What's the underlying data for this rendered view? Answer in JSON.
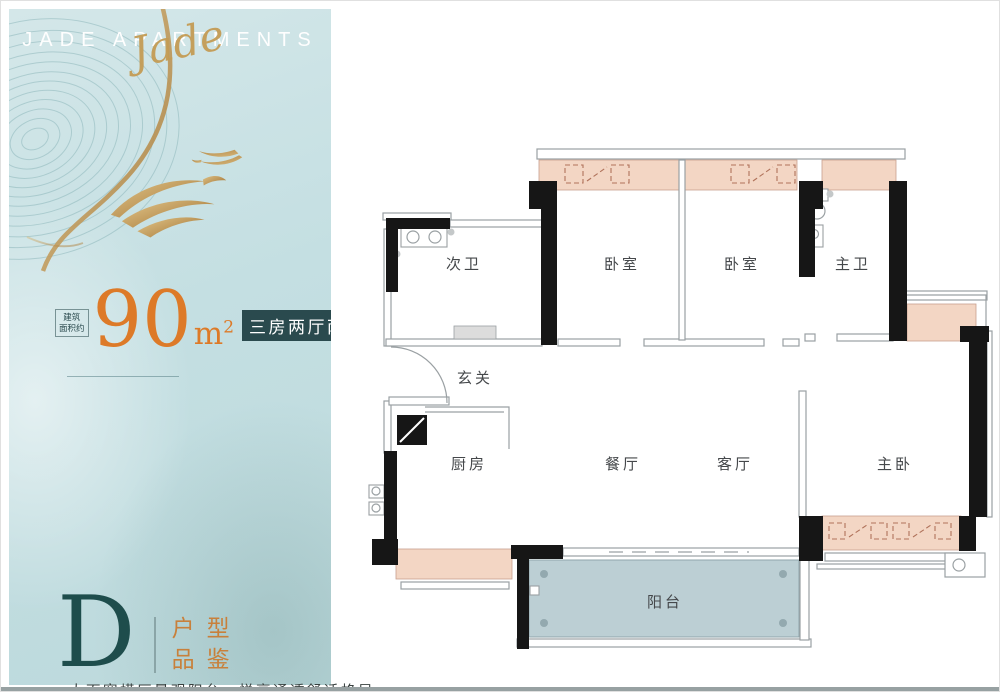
{
  "panel": {
    "brand": "JADE APARTMENTS",
    "brand_script": "Jade",
    "area": {
      "prefix_line1": "建筑",
      "prefix_line2": "面积约",
      "value": "90",
      "unit": "m",
      "unit_sup": "2"
    },
    "badge": "三房两厅两卫",
    "type": {
      "letter": "D",
      "label_line1": "户型",
      "label_line2": "品鉴"
    },
    "footer_caption": "大面宽横厅景观阳台，悦享通透舒适格局"
  },
  "plan": {
    "rooms": [
      {
        "label": "次卫"
      },
      {
        "label": "卧室"
      },
      {
        "label": "卧室"
      },
      {
        "label": "主卫"
      },
      {
        "label": "玄关"
      },
      {
        "label": "厨房"
      },
      {
        "label": "餐厅"
      },
      {
        "label": "客厅"
      },
      {
        "label": "主卧"
      },
      {
        "label": "阳台"
      }
    ]
  },
  "icons": {
    "swallow": "swallow-icon",
    "contours": "contour-lines-art"
  },
  "colors": {
    "accent_orange": "#dd7a28",
    "badge_teal": "#2a4a4e",
    "panel_blue": "#c6dfe1",
    "gold": "#c09a5c",
    "peach_fill": "#f3d6c4",
    "balcony_fill": "#bccfd4",
    "wall_black": "#161616",
    "letter_teal": "#1e4d4c"
  }
}
